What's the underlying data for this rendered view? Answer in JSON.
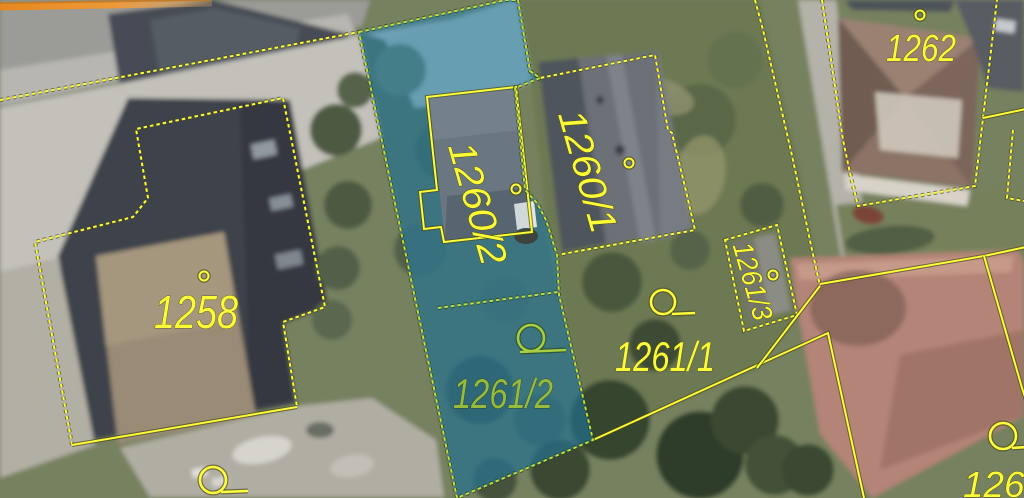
{
  "map": {
    "description": "Aerial cadastral map with parcel boundaries and a highlighted selection",
    "parcels": {
      "p1258": {
        "label": "1258"
      },
      "p1260_1": {
        "label": "1260/1"
      },
      "p1260_2": {
        "label": "1260/2"
      },
      "p1261_1": {
        "label": "1261/1"
      },
      "p1261_2": {
        "label": "1261/2"
      },
      "p1261_3": {
        "label": "1261/3"
      },
      "p1262": {
        "label": "1262"
      },
      "p1263": {
        "label": "1263"
      }
    },
    "selection": {
      "highlighted_parcels": [
        "1260/2",
        "1261/2"
      ],
      "fill_color": "#1b80b4",
      "outline_color": "#c3de44"
    },
    "colors": {
      "parcel_boundary": "#fdfd3c",
      "parcel_label": "#fafa38",
      "label_on_selection": "#97bb3e",
      "road_edge_highlight": "#ec8b27"
    },
    "symbols": {
      "boundary_point": "circle-with-tail-icon",
      "parcel_marker": "dot-circle-icon"
    }
  }
}
